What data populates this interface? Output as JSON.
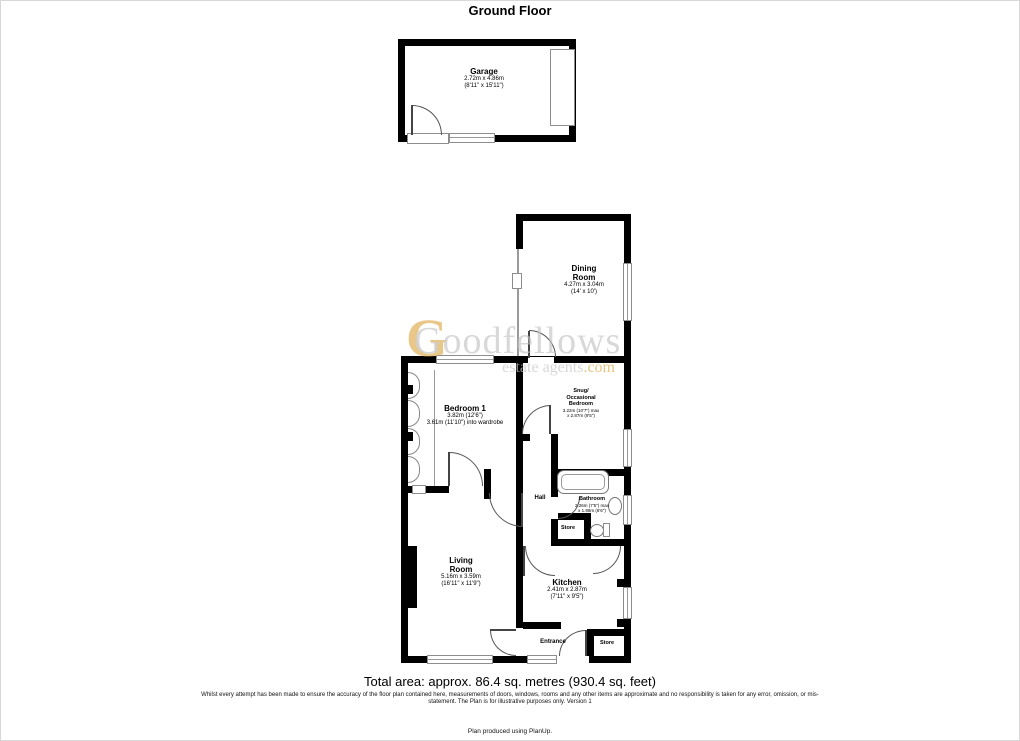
{
  "page": {
    "title": "Ground Floor",
    "total_area": "Total area: approx. 86.4 sq. metres (930.4 sq. feet)",
    "disclaimer_line1": "Whilst every attempt has been made to ensure the accuracy of the floor plan contained here, measurements of doors, windows, rooms and any other items are approximate and no responsibility is taken for any error, omission, or mis-",
    "disclaimer_line2": "statement. The Plan is for illustrative purposes only. Version 1",
    "credit": "Plan produced using PlanUp."
  },
  "watermark": {
    "initial": "G",
    "name": "Goodfellows",
    "tagline": "estate agents",
    "tld": ".com",
    "gold_color": "#ddad52",
    "gray_color": "#c3c3c3"
  },
  "rooms": {
    "garage": {
      "name": "Garage",
      "dims_metric": "2.72m x 4.86m",
      "dims_imperial": "(8'11\" x 15'11\")"
    },
    "dining": {
      "name_line1": "Dining",
      "name_line2": "Room",
      "dims_metric": "4.27m x 3.04m",
      "dims_imperial": "(14' x 10')"
    },
    "bedroom1": {
      "name": "Bedroom 1",
      "dims_line1": "3.82m (12'6\")",
      "dims_line2": "3.61m (11'10\") into wardrobe"
    },
    "snug": {
      "name_line1": "Snug/",
      "name_line2": "Occasional",
      "name_line3": "Bedroom",
      "dims_line1": "3.22m (10'7\") max",
      "dims_line2": "x 2.87m (9'5\")"
    },
    "bathroom": {
      "name": "Bathroom",
      "dims_line1": "2.26m (7'5\") max",
      "dims_line2": "x 1.98m (6'6\")"
    },
    "hall": {
      "name": "Hall"
    },
    "store1": {
      "name": "Store"
    },
    "living": {
      "name_line1": "Living",
      "name_line2": "Room",
      "dims_metric": "5.16m x 3.59m",
      "dims_imperial": "(16'11\" x 11'9\")"
    },
    "kitchen": {
      "name": "Kitchen",
      "dims_metric": "2.41m x 2.87m",
      "dims_imperial": "(7'11\" x 9'5\")"
    },
    "entrance": {
      "name": "Entrance"
    },
    "store2": {
      "name": "Store"
    }
  }
}
